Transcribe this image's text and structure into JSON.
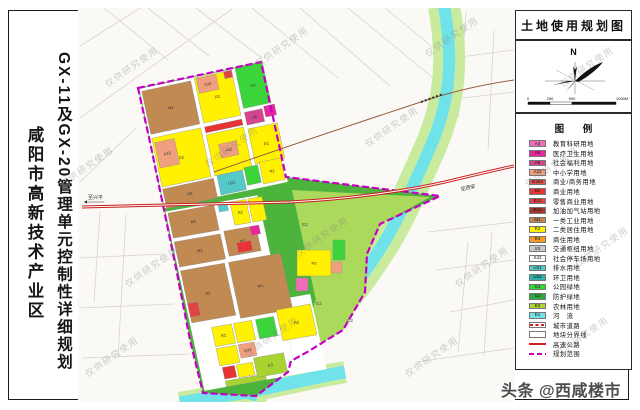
{
  "left_panel": {
    "title_main": "GX-11及GX-20管理单元控制性详细规划",
    "title_sub": "咸阳市高新技术产业区"
  },
  "right_panel": {
    "map_title": "土地使用规划图",
    "compass_label": "N",
    "scale": {
      "ticks": [
        "0",
        "250",
        "500",
        "1000M"
      ],
      "tick_x": [
        4,
        26,
        48,
        92
      ]
    },
    "legend_title": "图 例",
    "legend_items": [
      {
        "code": "A3",
        "label": "教育科研用地",
        "color": "#F06EB8",
        "type": "fill"
      },
      {
        "code": "A5",
        "label": "医疗卫生用地",
        "color": "#E8259B",
        "type": "fill"
      },
      {
        "code": "A6",
        "label": "社会福利用地",
        "color": "#D5458F",
        "type": "fill"
      },
      {
        "code": "A33",
        "label": "中小学用地",
        "color": "#F0A07E",
        "type": "fill"
      },
      {
        "code": "B1B2",
        "label": "商业/商务用地",
        "color": "#E85048",
        "type": "fill"
      },
      {
        "code": "B1",
        "label": "商业用地",
        "color": "#E63434",
        "type": "fill"
      },
      {
        "code": "B11",
        "label": "零售商业用地",
        "color": "#E04444",
        "type": "fill"
      },
      {
        "code": "B41",
        "label": "加油加气站用地",
        "color": "#A83830",
        "type": "fill"
      },
      {
        "code": "M1",
        "label": "一类工业用地",
        "color": "#C08A52",
        "type": "fill"
      },
      {
        "code": "R2",
        "label": "二类居住用地",
        "color": "#FFF100",
        "type": "fill"
      },
      {
        "code": "R4",
        "label": "商住用地",
        "color": "#F59A23",
        "type": "fill"
      },
      {
        "code": "S3",
        "label": "交通枢纽用地",
        "color": "#C9C9C9",
        "type": "fill"
      },
      {
        "code": "S42",
        "label": "社会停车场用地",
        "color": "#FFFFFF",
        "type": "fill"
      },
      {
        "code": "U21",
        "label": "排水用地",
        "color": "#55C8C8",
        "type": "fill"
      },
      {
        "code": "U22",
        "label": "环卫用地",
        "color": "#2FAFA8",
        "type": "fill"
      },
      {
        "code": "G1",
        "label": "公园绿地",
        "color": "#3BD53B",
        "type": "fill"
      },
      {
        "code": "G2",
        "label": "防护绿地",
        "color": "#2FA83E",
        "type": "fill"
      },
      {
        "code": "E2",
        "label": "农林用地",
        "color": "#A9D331",
        "type": "fill"
      },
      {
        "code": "E1",
        "label": "河　流",
        "color": "#6FE2EA",
        "type": "fill"
      },
      {
        "code": "",
        "label": "城市道路",
        "color": "#FFFFFF",
        "type": "road"
      },
      {
        "code": "",
        "label": "地块分界线",
        "color": "#FFFFFF",
        "type": "blank"
      },
      {
        "code": "",
        "label": "高速公路",
        "color": "#D22222",
        "type": "redline"
      },
      {
        "code": "",
        "label": "规划范围",
        "color": "#C400C4",
        "type": "purpledash"
      }
    ]
  },
  "map": {
    "bg": "#faf9f6",
    "grid_color": "#d8d4cc",
    "grid_lines": [
      [
        80,
        46,
        140,
        8
      ],
      [
        80,
        118,
        232,
        9
      ],
      [
        80,
        182,
        136,
        128
      ],
      [
        104,
        8,
        168,
        60
      ],
      [
        148,
        8,
        209,
        56
      ],
      [
        196,
        8,
        262,
        58
      ],
      [
        252,
        8,
        338,
        78
      ],
      [
        300,
        8,
        390,
        86
      ],
      [
        348,
        8,
        438,
        82
      ],
      [
        385,
        8,
        436,
        50
      ],
      [
        80,
        258,
        162,
        254
      ],
      [
        80,
        308,
        174,
        304
      ],
      [
        82,
        358,
        190,
        354
      ],
      [
        100,
        212,
        94,
        302
      ],
      [
        126,
        214,
        118,
        358
      ],
      [
        466,
        12,
        458,
        118
      ],
      [
        494,
        30,
        488,
        150
      ],
      [
        452,
        58,
        514,
        50
      ],
      [
        446,
        100,
        514,
        92
      ],
      [
        428,
        232,
        514,
        222
      ],
      [
        436,
        270,
        514,
        260
      ],
      [
        450,
        312,
        514,
        300
      ],
      [
        468,
        242,
        458,
        352
      ],
      [
        492,
        232,
        484,
        356
      ],
      [
        416,
        362,
        514,
        348
      ]
    ],
    "river": {
      "path": "M444,6 C450,40 451,68 446,96 C440,130 428,152 413,186 C398,220 384,246 358,281 C336,310 304,340 281,359 C263,373 254,384 250,400",
      "mouth_path": "M345,372 C310,378 270,388 235,394 C215,397 195,400 180,403",
      "bank_color": "#c8eb9e",
      "water_color": "#6FE2EA"
    },
    "boundary": {
      "points": "138,88 261,62 286,177 350,185 440,196 380,224 367,254 365,292 343,330 309,351 291,361 288,372 256,396 203,393 190,340 176,268 163,205 150,142",
      "color": "#c400c4",
      "base_fill": "#4cb43c"
    },
    "east_zone": {
      "points": "292,190 430,197 381,224 368,253 366,291 344,329 311,349 293,359 316,300 301,232",
      "color": "#abd95c"
    },
    "upper_block": {
      "transform": "rotate(-12 138 88)",
      "underlays": [
        [
          139,
          89,
          126,
          122
        ]
      ],
      "parcels": [
        [
          141,
          92,
          50,
          44,
          "M1",
          "M1"
        ],
        [
          195,
          90,
          38,
          46,
          "R2",
          "R2"
        ],
        [
          197,
          91,
          20,
          15,
          "A33",
          "A33"
        ],
        [
          225,
          90,
          8,
          7,
          "B11",
          ""
        ],
        [
          237,
          88,
          28,
          42,
          "G1",
          "G1"
        ],
        [
          141,
          140,
          50,
          50,
          "R2",
          "R2"
        ],
        [
          143,
          145,
          20,
          26,
          "A33",
          "A33"
        ],
        [
          195,
          140,
          38,
          6,
          "B1",
          ""
        ],
        [
          195,
          148,
          38,
          42,
          "R2",
          "R2"
        ],
        [
          205,
          160,
          18,
          14,
          "A33",
          "A33"
        ],
        [
          237,
          134,
          18,
          13,
          "A6",
          "A6"
        ],
        [
          257,
          132,
          11,
          11,
          "A5",
          ""
        ],
        [
          237,
          151,
          30,
          36,
          "R2",
          "R2"
        ],
        [
          141,
          192,
          52,
          20,
          "M1",
          "M1"
        ],
        [
          197,
          190,
          26,
          20,
          "U21",
          "U21"
        ],
        [
          225,
          188,
          14,
          18,
          "G1",
          ""
        ],
        [
          241,
          186,
          22,
          22,
          "R2",
          "R2"
        ]
      ]
    },
    "lower_block": {
      "transform": "matrix(1,-0.177,0.21,0.963,163,210)",
      "underlays": [
        [
          2,
          2,
          92,
          186
        ],
        [
          94,
          110,
          30,
          78
        ]
      ],
      "parcels": [
        [
          4,
          4,
          46,
          26,
          "M1",
          "M1"
        ],
        [
          54,
          4,
          9,
          8,
          "U21",
          ""
        ],
        [
          66,
          4,
          16,
          24,
          "R2",
          "R2"
        ],
        [
          84,
          4,
          14,
          24,
          "R2",
          ""
        ],
        [
          4,
          34,
          46,
          26,
          "M1",
          "M1"
        ],
        [
          54,
          32,
          32,
          26,
          "M1",
          "M1"
        ],
        [
          80,
          32,
          9,
          9,
          "A5",
          ""
        ],
        [
          64,
          46,
          14,
          10,
          "B1",
          ""
        ],
        [
          4,
          64,
          44,
          54,
          "M1",
          "M1"
        ],
        [
          52,
          64,
          52,
          58,
          "M1",
          "M1"
        ],
        [
          4,
          98,
          10,
          14,
          "B11",
          ""
        ],
        [
          22,
          126,
          20,
          20,
          "R2",
          "R2"
        ],
        [
          44,
          126,
          18,
          20,
          "R2",
          ""
        ],
        [
          66,
          126,
          18,
          20,
          "G1",
          ""
        ],
        [
          22,
          148,
          20,
          18,
          "R2",
          ""
        ],
        [
          44,
          148,
          16,
          14,
          "A33",
          "A33"
        ],
        [
          24,
          168,
          12,
          12,
          "B1",
          ""
        ],
        [
          38,
          168,
          16,
          13,
          "R2",
          ""
        ],
        [
          24,
          182,
          40,
          6,
          "E2",
          ""
        ],
        [
          88,
          120,
          34,
          32,
          "R2",
          "R2"
        ],
        [
          56,
          164,
          30,
          20,
          "E2",
          "E2"
        ]
      ]
    },
    "global_parcels": [
      [
        297,
        250,
        34,
        26,
        "R2",
        "R2"
      ],
      [
        331,
        262,
        11,
        11,
        "A33",
        ""
      ],
      [
        296,
        278,
        12,
        13,
        "A3",
        ""
      ],
      [
        333,
        240,
        12,
        20,
        "G1",
        ""
      ]
    ],
    "zone_labels": [
      [
        319,
        305,
        "E2"
      ],
      [
        305,
        226,
        "E2"
      ],
      [
        350,
        322,
        "G2"
      ]
    ],
    "bridge_road": {
      "path": "M214,172 C300,142 375,117 430,99 C458,90 487,84 514,80",
      "bridge_path": "M421,102 L443,94",
      "color": "#9a5b40"
    },
    "highway": {
      "path": "M82,207 L290,202 C350,199 405,191 445,182 C470,176 495,170 514,166",
      "color": "#c81e1e",
      "label_left": "至兴平",
      "label_left_pos": [
        88,
        199
      ],
      "label_left_arrow": [
        84,
        202,
        104,
        202
      ],
      "label_right": "至西安",
      "label_right_pos": [
        461,
        191
      ]
    }
  },
  "watermark": {
    "text": "仅供研究使用",
    "credit": "头条 @西咸楼市"
  }
}
